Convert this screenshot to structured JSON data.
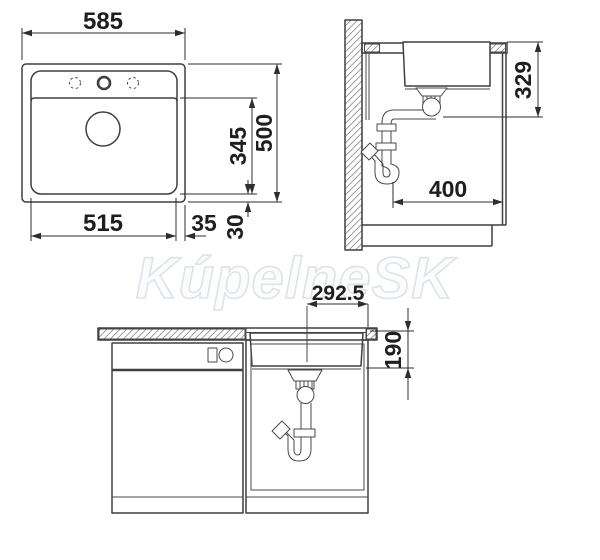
{
  "drawing": {
    "watermark": "KúpelneSK",
    "views": {
      "plan": {
        "dims": {
          "overall_width": "585",
          "overall_depth": "500",
          "bowl_width": "515",
          "bowl_depth": "345",
          "rim_side": "35",
          "rim_front": "30"
        }
      },
      "side": {
        "dims": {
          "drain_height": "329",
          "install_depth": "400"
        }
      },
      "front": {
        "dims": {
          "drain_center": "292.5",
          "bowl_height": "190"
        }
      }
    },
    "colors": {
      "line": "#3f3f3f",
      "dim_text": "#1e1e1e",
      "watermark_stroke": "#dde3e8"
    }
  }
}
